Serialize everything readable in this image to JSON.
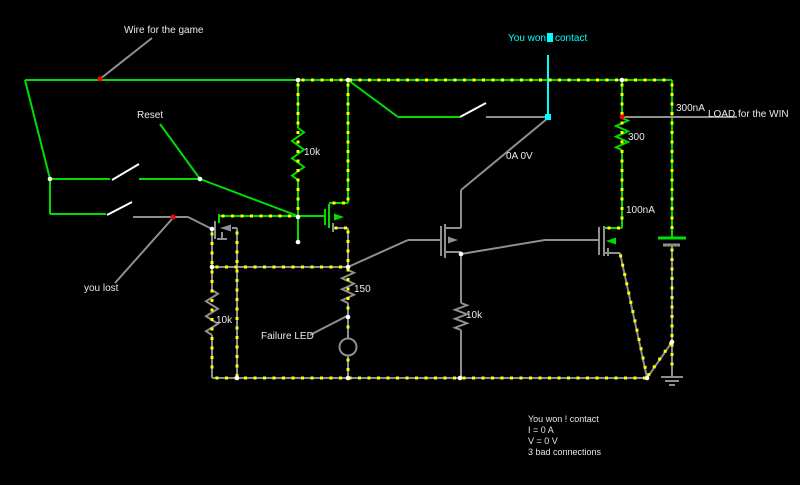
{
  "app": {
    "background": "#000000"
  },
  "colors": {
    "wire_high": "#00dd00",
    "wire_neutral": "#8f8f8f",
    "current_dot": "#ffff00",
    "selection": "#00ffff",
    "marker": "#ff0000",
    "post": "#ffffff",
    "text": "#eceaea"
  },
  "annotations": {
    "wire_for_game": "Wire for the game",
    "reset": "Reset",
    "you_lost": "you lost",
    "failure_led": "Failure LED",
    "load_for_win": "LOAD for the WIN",
    "editing_label": {
      "prefix": "You won",
      "suffix": "contact"
    }
  },
  "readings": {
    "mosfet_drain": "0A 0V",
    "load_current": "300nA",
    "gate_current": "100nA"
  },
  "components": {
    "resistor_pullup": "10k",
    "resistor_load": "300",
    "resistor_led": "150",
    "resistor_left": "10k",
    "resistor_mid": "10k"
  },
  "status_panel": {
    "lines": [
      "You won ! contact",
      "I = 0 A",
      "V = 0 V",
      "3 bad connections"
    ]
  }
}
